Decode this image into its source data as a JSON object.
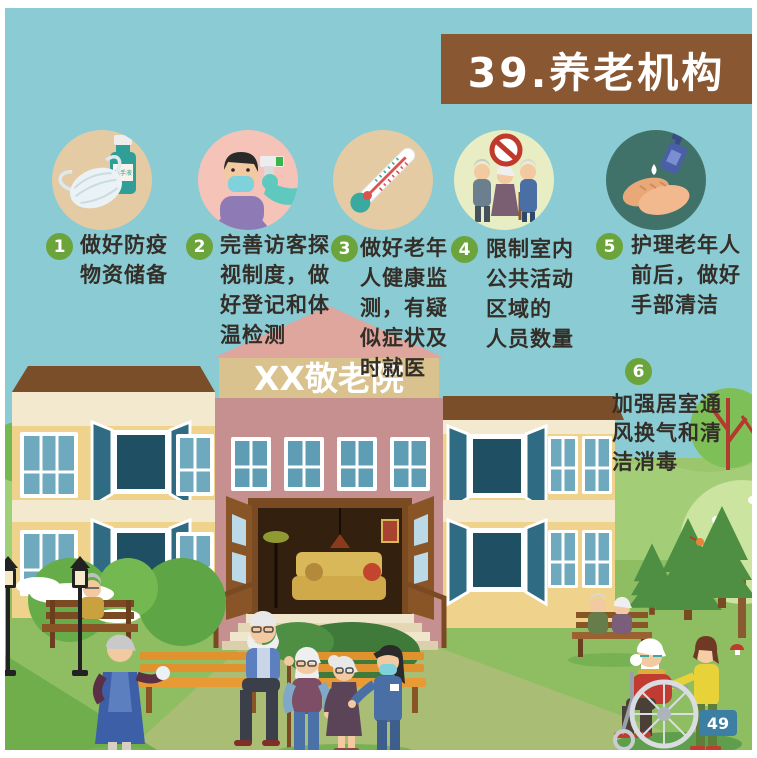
{
  "poster": {
    "title": "39.养老机构",
    "page_number": "49",
    "building_sign": "XX敬老院",
    "sanitizer_label": "洗手液"
  },
  "tips": [
    {
      "number": "1",
      "icon": "mask-and-sanitizer-icon",
      "text": "做好防疫物资储备",
      "lines": [
        "做好防疫",
        "物资储备"
      ]
    },
    {
      "number": "2",
      "icon": "visitor-temperature-check-icon",
      "text": "完善访客探视制度，做好登记和体温检测",
      "lines": [
        "完善访客探",
        "视制度，做",
        "好登记和体",
        "温检测"
      ]
    },
    {
      "number": "3",
      "icon": "thermometer-icon",
      "text": "做好老年人健康监测，有疑似症状及时就医",
      "lines": [
        "做好老年",
        "人健康监",
        "测，有疑",
        "似症状及",
        "时就医"
      ]
    },
    {
      "number": "4",
      "icon": "limit-gathering-icon",
      "text": "限制室内公共活动区域的人员数量",
      "lines": [
        "限制室内",
        "公共活动",
        "区域的",
        "人员数量"
      ]
    },
    {
      "number": "5",
      "icon": "hand-hygiene-icon",
      "text": "护理老年人前后，做好手部清洁",
      "lines": [
        "护理老年人",
        "前后，做好",
        "手部清洁"
      ]
    },
    {
      "number": "6",
      "icon": "ventilation-icon",
      "text": "加强居室通风换气和清洁消毒",
      "lines": [
        "加强居室通",
        "风换气和清",
        "洁消毒"
      ]
    }
  ],
  "colors": {
    "sky": "#8BCBD3",
    "banner_brown": "#8A5733",
    "tip_badge_green": "#6BA43B",
    "icon_bg_tan": "#E5CBA4",
    "icon_bg_pink": "#F6C3B9",
    "icon_bg_pale_green": "#E9EDC3",
    "icon_bg_dark_green": "#41726A",
    "building_yellow": "#EFD28B",
    "building_pink": "#C79090",
    "sign_tan": "#D9C28E",
    "roof_brown": "#7A4E28",
    "grass_green": "#8FBE62",
    "page_badge_blue": "#3D7FA3"
  }
}
